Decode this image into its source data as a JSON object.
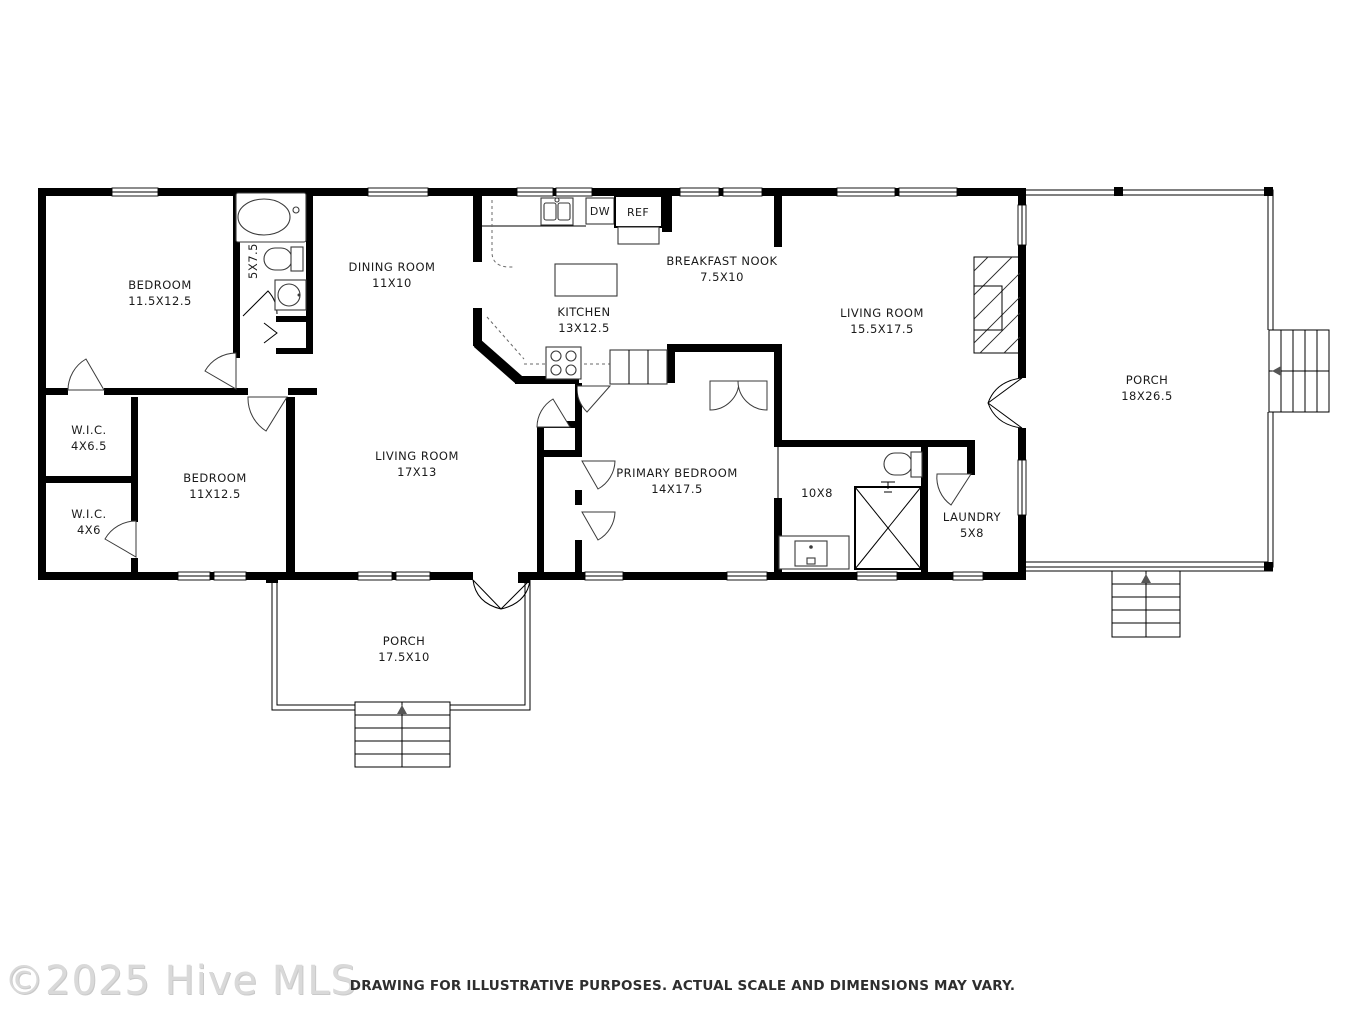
{
  "footer": {
    "watermark": "©2025 Hive MLS",
    "disclaimer": "DRAWING FOR ILLUSTRATIVE PURPOSES. ACTUAL SCALE AND DIMENSIONS MAY VARY."
  },
  "rooms": {
    "bedroom1": {
      "name": "BEDROOM",
      "dims": "11.5X12.5"
    },
    "bath1": {
      "dims": "5X7.5"
    },
    "dining": {
      "name": "DINING ROOM",
      "dims": "11X10"
    },
    "kitchen": {
      "name": "KITCHEN",
      "dims": "13X12.5"
    },
    "breakfast_nook": {
      "name": "BREAKFAST NOOK",
      "dims": "7.5X10"
    },
    "living_main": {
      "name": "LIVING ROOM",
      "dims": "15.5X17.5"
    },
    "porch_right": {
      "name": "PORCH",
      "dims": "18X26.5"
    },
    "wic1": {
      "name": "W.I.C.",
      "dims": "4X6.5"
    },
    "bedroom2": {
      "name": "BEDROOM",
      "dims": "11X12.5"
    },
    "wic2": {
      "name": "W.I.C.",
      "dims": "4X6"
    },
    "living2": {
      "name": "LIVING ROOM",
      "dims": "17X13"
    },
    "primary": {
      "name": "PRIMARY BEDROOM",
      "dims": "14X17.5"
    },
    "bath2": {
      "dims": "10X8"
    },
    "laundry": {
      "name": "LAUNDRY",
      "dims": "5X8"
    },
    "porch_bottom": {
      "name": "PORCH",
      "dims": "17.5X10"
    }
  },
  "appliances": {
    "dishwasher": "DW",
    "refrigerator": "REF"
  },
  "colors": {
    "wall": "#000000",
    "label_text": "#1a1a1a",
    "watermark": "#d9d9d9"
  }
}
